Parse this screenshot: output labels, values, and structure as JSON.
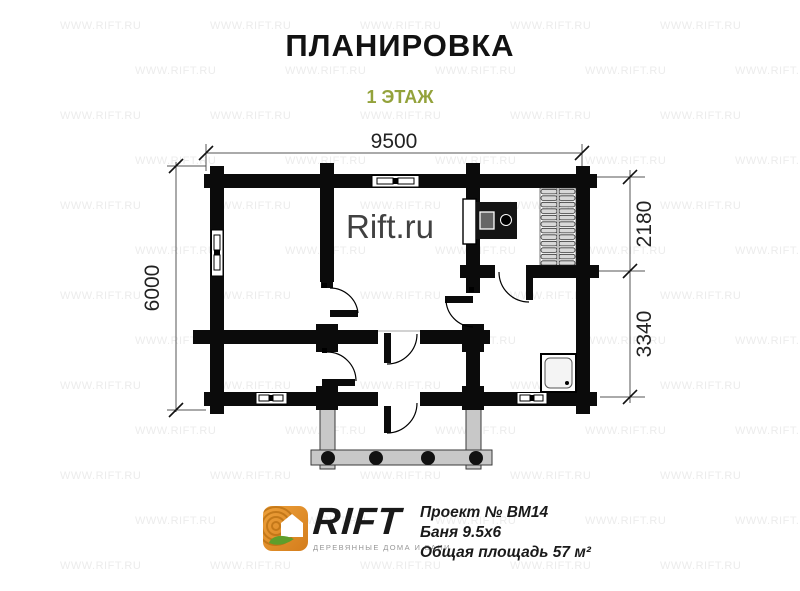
{
  "header": {
    "title": "ПЛАНИРОВКА",
    "subtitle": "1 ЭТАЖ",
    "subtitle_color": "#93a23b"
  },
  "plan": {
    "center_watermark": "Rift.ru",
    "dimensions": {
      "width": "9500",
      "depth": "6000",
      "sauna_depth": "2180",
      "washroom_depth": "3340"
    }
  },
  "watermark": {
    "text": "WWW.RIFT.RU"
  },
  "footer": {
    "logo": {
      "name": "RIFT",
      "tagline": "ДЕРЕВЯННЫЕ ДОМА И БАНИ",
      "orange": "#e08b27",
      "leaf_green": "#5f9e2b"
    },
    "project": {
      "line1": "Проект № ВМ14",
      "line2": "Баня 9.5х6",
      "line3": "Общая площадь 57 м²"
    }
  }
}
